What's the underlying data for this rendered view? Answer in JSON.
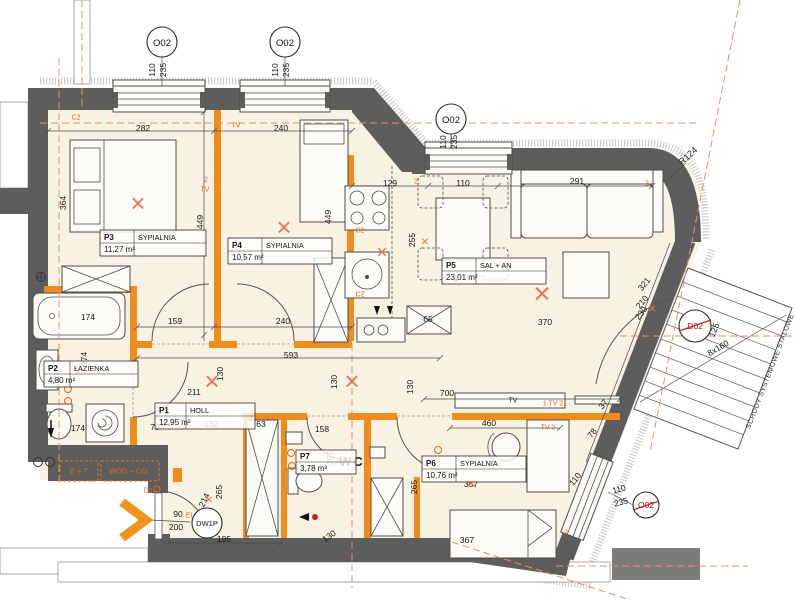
{
  "rooms": [
    {
      "id": "P1",
      "name": "HOLL",
      "area": "12,95 m²"
    },
    {
      "id": "P2",
      "name": "ŁAZIENKA",
      "area": "4,80 m²"
    },
    {
      "id": "P3",
      "name": "SYPIALNIA",
      "area": "11,27 m²"
    },
    {
      "id": "P4",
      "name": "SYPIALNIA",
      "area": "10,57 m²"
    },
    {
      "id": "P5",
      "name": "SAL + AN",
      "area": "23,01 m²"
    },
    {
      "id": "P6",
      "name": "SYPIALNIA",
      "area": "10,76 m²"
    },
    {
      "id": "P7",
      "name": "WC",
      "area": "3,78 m²"
    }
  ],
  "windows": {
    "tag": "O02",
    "width": "110",
    "height": "235"
  },
  "doors": {
    "entry_tag": "DW1P",
    "stairs_tag": "D02"
  },
  "stairs": {
    "label": "SCHODY SYSTEMOWE STALOWE"
  },
  "annotations": {
    "radius": "R124"
  },
  "colors": {
    "wall_dark": "#5d5d5d",
    "wall_orange": "#ef8c1a",
    "floor": "#f7f2e1",
    "annotation_orange": "#e06a10",
    "axis_salmon": "#e8906a",
    "red": "#cf1f1f"
  },
  "dimensions": [
    {
      "t": "282",
      "x": 143,
      "y": 128
    },
    {
      "t": "240",
      "x": 281,
      "y": 128
    },
    {
      "t": "364",
      "x": 63,
      "y": 203,
      "r": -90
    },
    {
      "t": "449",
      "x": 200,
      "y": 222,
      "r": -90
    },
    {
      "t": "449",
      "x": 328,
      "y": 217,
      "r": -90
    },
    {
      "t": "129",
      "x": 390,
      "y": 183
    },
    {
      "t": "110",
      "x": 463,
      "y": 183
    },
    {
      "t": "291",
      "x": 577,
      "y": 181
    },
    {
      "t": "255",
      "x": 412,
      "y": 240,
      "r": -90
    },
    {
      "t": "370",
      "x": 545,
      "y": 322
    },
    {
      "t": "321",
      "x": 644,
      "y": 284,
      "r": -52
    },
    {
      "t": "210",
      "x": 642,
      "y": 302,
      "r": -52
    },
    {
      "t": "230",
      "x": 641,
      "y": 313,
      "r": -52
    },
    {
      "t": "174",
      "x": 88,
      "y": 317
    },
    {
      "t": "274",
      "x": 84,
      "y": 359,
      "r": -90
    },
    {
      "t": "174",
      "x": 78,
      "y": 428
    },
    {
      "t": "159",
      "x": 175,
      "y": 321
    },
    {
      "t": "240",
      "x": 283,
      "y": 321
    },
    {
      "t": "593",
      "x": 291,
      "y": 355
    },
    {
      "t": "130",
      "x": 220,
      "y": 374,
      "r": -90
    },
    {
      "t": "211",
      "x": 194,
      "y": 392
    },
    {
      "t": "130",
      "x": 334,
      "y": 382,
      "r": -90
    },
    {
      "t": "130",
      "x": 410,
      "y": 387,
      "r": -90
    },
    {
      "t": "700",
      "x": 447,
      "y": 393
    },
    {
      "t": "79",
      "x": 155,
      "y": 427
    },
    {
      "t": "132",
      "x": 211,
      "y": 424
    },
    {
      "t": "63",
      "x": 261,
      "y": 424
    },
    {
      "t": "158",
      "x": 322,
      "y": 429
    },
    {
      "t": "265",
      "x": 330,
      "y": 458,
      "r": -90
    },
    {
      "t": "265",
      "x": 414,
      "y": 487,
      "r": -90
    },
    {
      "t": "130",
      "x": 329,
      "y": 536,
      "r": -35
    },
    {
      "t": "460",
      "x": 489,
      "y": 423
    },
    {
      "t": "367",
      "x": 471,
      "y": 484
    },
    {
      "t": "367",
      "x": 467,
      "y": 540
    },
    {
      "t": "110",
      "x": 575,
      "y": 479,
      "r": -52
    },
    {
      "t": "78",
      "x": 592,
      "y": 433,
      "r": -52
    },
    {
      "t": "37",
      "x": 603,
      "y": 404,
      "r": -52
    },
    {
      "t": "110",
      "x": 619,
      "y": 489,
      "r": -15
    },
    {
      "t": "235",
      "x": 621,
      "y": 502,
      "r": -15
    },
    {
      "t": "195",
      "x": 224,
      "y": 539
    },
    {
      "t": "90",
      "x": 178,
      "y": 514
    },
    {
      "t": "200",
      "x": 176,
      "y": 527
    },
    {
      "t": "214",
      "x": 204,
      "y": 500,
      "r": -65
    },
    {
      "t": "265",
      "x": 219,
      "y": 492,
      "r": -90
    },
    {
      "t": "65",
      "x": 428,
      "y": 319
    },
    {
      "t": "8x160",
      "x": 718,
      "y": 348,
      "r": -30
    },
    {
      "t": "125",
      "x": 714,
      "y": 330,
      "r": -69
    },
    {
      "t": "110",
      "x": 152,
      "y": 70,
      "r": -90
    },
    {
      "t": "235",
      "x": 163,
      "y": 70,
      "r": -90
    },
    {
      "t": "110",
      "x": 275,
      "y": 70,
      "r": -90
    },
    {
      "t": "235",
      "x": 286,
      "y": 70,
      "r": -90
    },
    {
      "t": "110",
      "x": 443,
      "y": 142,
      "r": -90
    },
    {
      "t": "235",
      "x": 454,
      "y": 142,
      "r": -90
    }
  ],
  "micro_labels": [
    {
      "t": "C2",
      "x": 76,
      "y": 118
    },
    {
      "t": "TV",
      "x": 236,
      "y": 126
    },
    {
      "t": "2",
      "x": 206,
      "y": 180
    },
    {
      "t": "TV",
      "x": 205,
      "y": 190
    },
    {
      "t": "C2",
      "x": 360,
      "y": 231
    },
    {
      "t": "C2",
      "x": 360,
      "y": 295
    },
    {
      "t": "2",
      "x": 416,
      "y": 182
    },
    {
      "t": "2",
      "x": 647,
      "y": 184
    },
    {
      "t": "TV",
      "x": 513,
      "y": 401,
      "c": "#222222"
    },
    {
      "t": "1 TV 2",
      "x": 553,
      "y": 404
    },
    {
      "t": "TV 2",
      "x": 548,
      "y": 428
    },
    {
      "t": "2",
      "x": 566,
      "y": 533
    },
    {
      "t": "Dz",
      "x": 148,
      "y": 491
    },
    {
      "t": "EL",
      "x": 190,
      "y": 516
    },
    {
      "t": "E + T",
      "x": 79,
      "y": 471,
      "s": 7.5
    },
    {
      "t": "WOD + CO",
      "x": 128,
      "y": 471,
      "s": 7.5
    },
    {
      "t": "×",
      "x": 138,
      "y": 203,
      "s": 26,
      "c": "#e87850"
    },
    {
      "t": "×",
      "x": 284,
      "y": 227,
      "s": 26,
      "c": "#e87850"
    },
    {
      "t": "×",
      "x": 382,
      "y": 253,
      "s": 19,
      "c": "#e87850"
    },
    {
      "t": "×",
      "x": 542,
      "y": 294,
      "s": 30,
      "c": "#e87850"
    },
    {
      "t": "×",
      "x": 425,
      "y": 241,
      "s": 14,
      "c": "#e87850"
    },
    {
      "t": "×",
      "x": 212,
      "y": 381,
      "s": 26,
      "c": "#e87850"
    },
    {
      "t": "×",
      "x": 352,
      "y": 381,
      "s": 26,
      "c": "#e87850"
    },
    {
      "t": "×",
      "x": 80,
      "y": 371,
      "s": 19,
      "c": "#e87850"
    },
    {
      "t": "×",
      "x": 338,
      "y": 461,
      "s": 17,
      "c": "#e87850"
    },
    {
      "t": "×",
      "x": 471,
      "y": 484,
      "s": 19,
      "c": "#e87850"
    },
    {
      "t": "×",
      "x": 652,
      "y": 308,
      "s": 14,
      "c": "#e87850"
    },
    {
      "t": "×",
      "x": 209,
      "y": 499,
      "s": 14,
      "c": "#e87850"
    }
  ]
}
